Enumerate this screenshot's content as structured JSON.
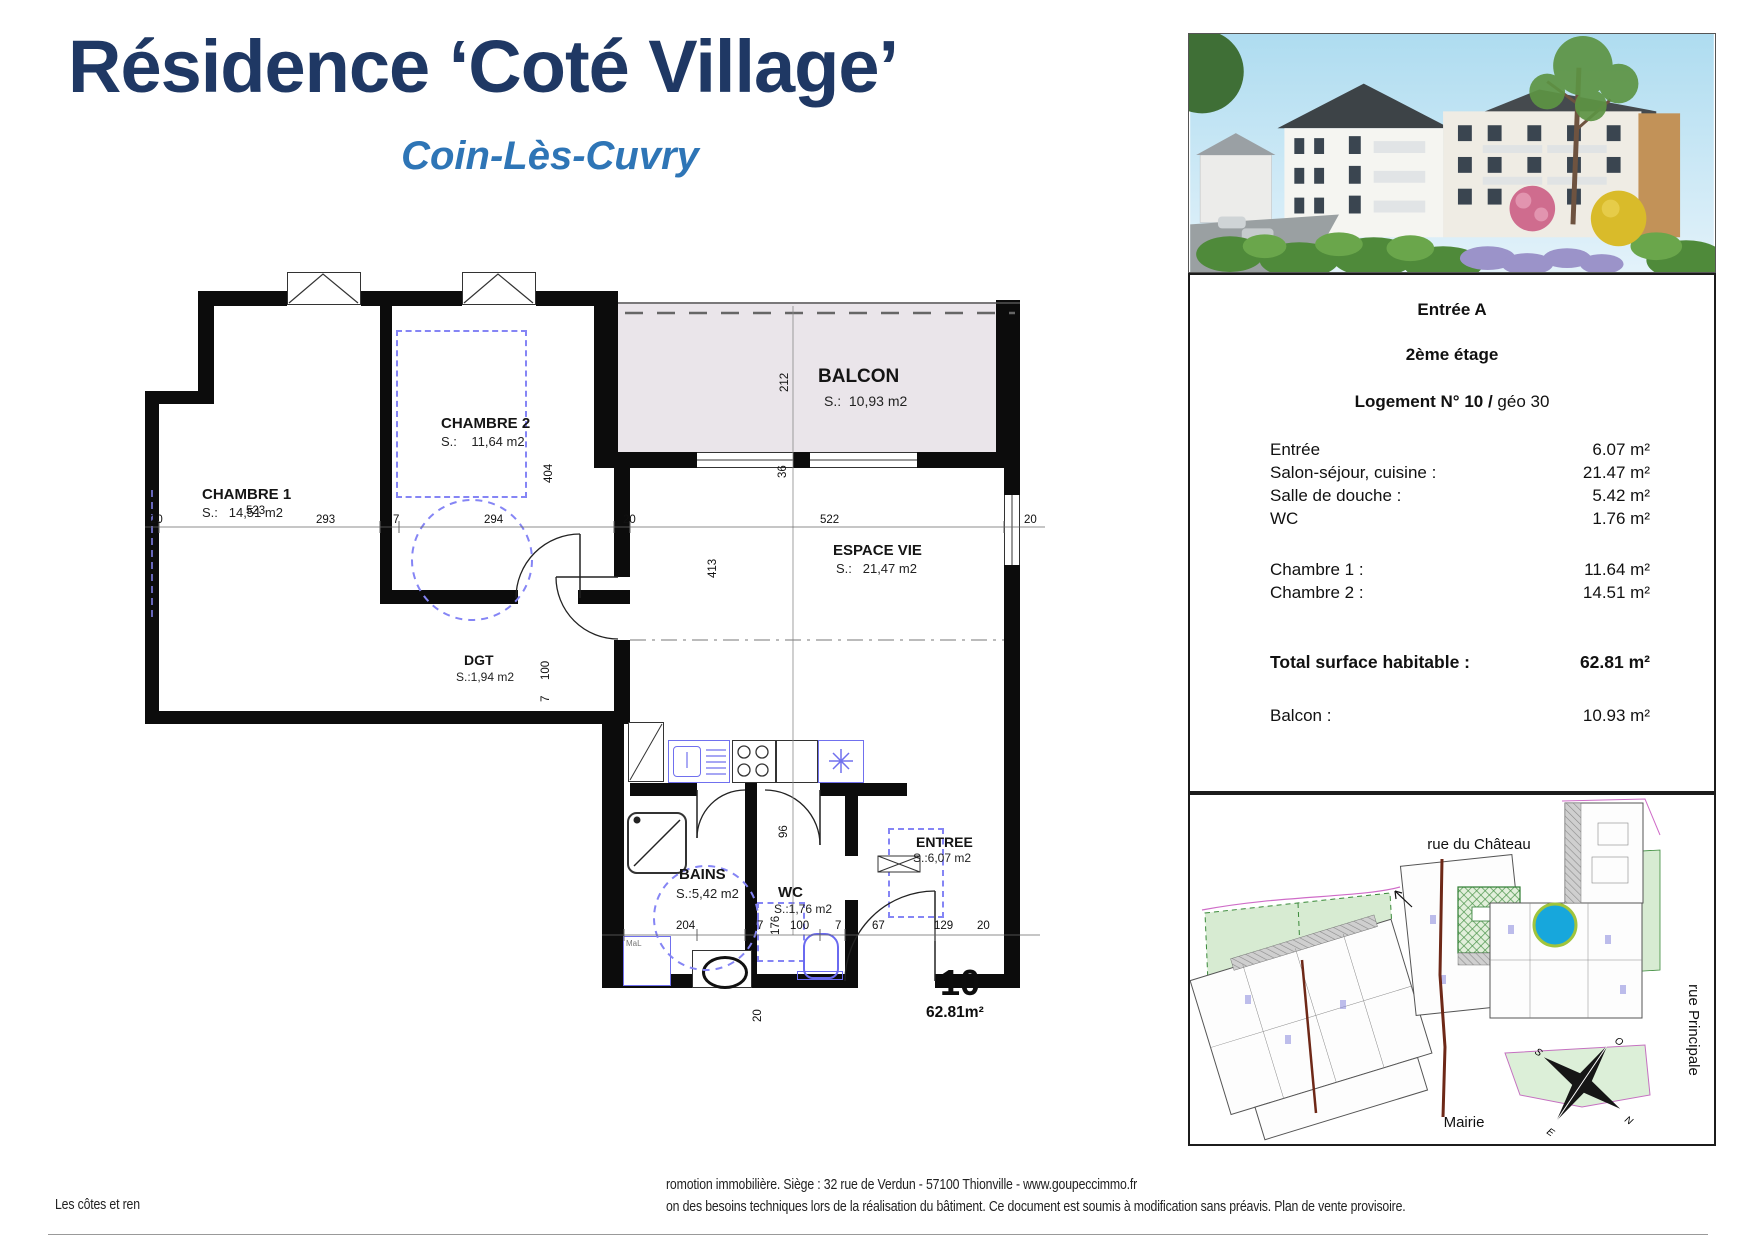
{
  "header": {
    "title": "Résidence ‘Coté Village’",
    "subtitle": "Coin-Lès-Cuvry"
  },
  "floorplan": {
    "rooms": [
      {
        "name": "CHAMBRE 2",
        "area": "S.:    11,64 m2"
      },
      {
        "name": "CHAMBRE 1",
        "area": "S.:   14,51 m2"
      },
      {
        "name": "BALCON",
        "area": "S.:  10,93 m2"
      },
      {
        "name": "ESPACE VIE",
        "area": "S.:   21,47 m2"
      },
      {
        "name": "DGT",
        "area": "S.:1,94 m2"
      },
      {
        "name": "BAINS",
        "area": "S.:5,42 m2"
      },
      {
        "name": "WC",
        "area": "S.:1,76 m2"
      },
      {
        "name": "ENTREE",
        "area": "S.:6,07 m2"
      }
    ],
    "unit": {
      "number": "10",
      "area": "62.81m²"
    },
    "appliance_label": "MaL",
    "dims": {
      "top": [
        "20",
        "523",
        "293",
        "7",
        "294",
        "20",
        "522",
        "20"
      ],
      "bottom": [
        "204",
        "7",
        "100",
        "7",
        "67",
        "129",
        "20"
      ],
      "vert": [
        "212",
        "36",
        "404",
        "413",
        "100",
        "7",
        "96",
        "176",
        "20"
      ]
    }
  },
  "details": {
    "entrance": "Entrée A",
    "floor": "2ème étage",
    "unit_line_bold": "Logement N° 10 /",
    "unit_line_rest": " géo 30",
    "rows": [
      {
        "label": "Entrée",
        "value": "6.07 m²"
      },
      {
        "label": "Salon-séjour, cuisine :",
        "value": "21.47 m²"
      },
      {
        "label": "Salle de douche :",
        "value": "5.42 m²"
      },
      {
        "label": "WC",
        "value": "1.76 m²"
      }
    ],
    "rows2": [
      {
        "label": "Chambre 1 :",
        "value": "11.64 m²"
      },
      {
        "label": "Chambre 2 :",
        "value": "14.51 m²"
      }
    ],
    "total": {
      "label": "Total surface habitable :",
      "value": "62.81 m²"
    },
    "balcony": {
      "label": "Balcon :",
      "value": "10.93 m²"
    }
  },
  "siteplan": {
    "street_top": "rue du Château",
    "street_right": "rue Principale",
    "landmark": "Mairie",
    "compass": {
      "o": "O",
      "n": "N",
      "e": "E",
      "s": "S"
    }
  },
  "footer": {
    "left": "Les côtes et ren",
    "line1": "romotion immobilière. Siège : 32 rue de Verdun - 57100 Thionville - www.goupeccimmo.fr",
    "line2": "on des besoins techniques lors de la réalisation du bâtiment. Ce document est soumis à modification sans préavis. Plan de vente provisoire."
  },
  "colors": {
    "title_navy": "#1f3864",
    "subtitle_blue": "#2e75b6",
    "marker_cyan": "#17a7dc",
    "marker_ring": "#a0c43c",
    "furniture_blue": "#8585f5",
    "balcony_fill": "#eae5ea"
  }
}
